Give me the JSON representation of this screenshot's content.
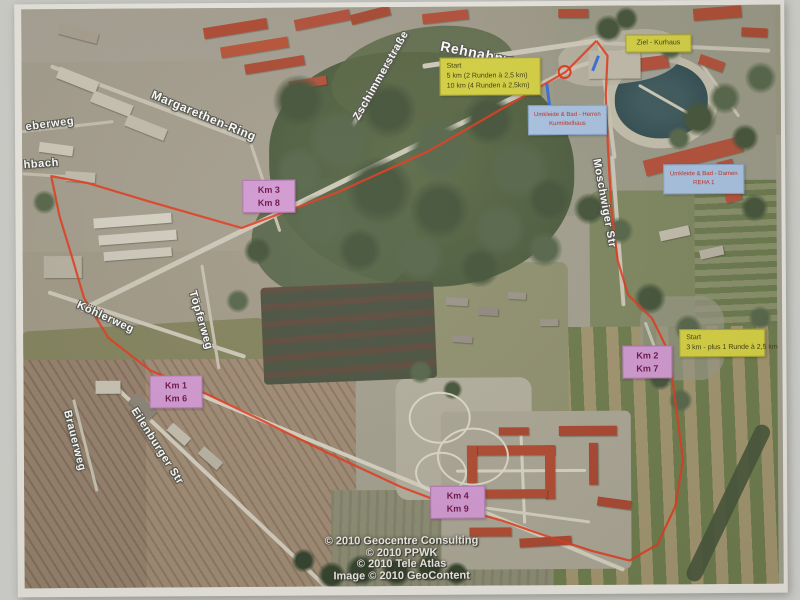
{
  "street_labels": [
    {
      "id": "rehnahnweg",
      "text": "Rehnahnweg",
      "x": 444,
      "y": 38,
      "rot": 12,
      "size": 14
    },
    {
      "id": "zschimmerstrasse",
      "text": "Zschimmerstraße",
      "x": 352,
      "y": 116,
      "rot": -60,
      "size": 11
    },
    {
      "id": "margarethen-ring",
      "text": "Margarethen-Ring",
      "x": 156,
      "y": 86,
      "rot": 23,
      "size": 12
    },
    {
      "id": "eberweg",
      "text": "eberweg",
      "x": 26,
      "y": 119,
      "rot": -7,
      "size": 11
    },
    {
      "id": "hbach",
      "text": "hbach",
      "x": 24,
      "y": 157,
      "rot": -4,
      "size": 11
    },
    {
      "id": "koehlerweg",
      "text": "Köhlerweg",
      "x": 80,
      "y": 297,
      "rot": 25,
      "size": 11
    },
    {
      "id": "toepferweg",
      "text": "Töpferweg",
      "x": 198,
      "y": 288,
      "rot": 74,
      "size": 11
    },
    {
      "id": "brauerweg",
      "text": "Brauerweg",
      "x": 72,
      "y": 407,
      "rot": 76,
      "size": 11
    },
    {
      "id": "eilenburger-str",
      "text": "Eilenburger Str",
      "x": 138,
      "y": 404,
      "rot": 58,
      "size": 11
    },
    {
      "id": "moschwiger-str",
      "text": "Moschwiger Str",
      "x": 603,
      "y": 159,
      "rot": 80,
      "size": 11
    }
  ],
  "boxes": {
    "start_main": {
      "x": 441,
      "y": 58,
      "w": 101,
      "h": 38,
      "lines": [
        "Start",
        "5 km (2 Runden à 2,5 km)",
        "10 km (4 Runden à 2,5km)"
      ]
    },
    "ziel": {
      "x": 627,
      "y": 36,
      "w": 66,
      "h": 18,
      "lines": [
        "Ziel - Kurhaus"
      ]
    },
    "start_3km": {
      "x": 679,
      "y": 331,
      "w": 86,
      "h": 28,
      "lines": [
        "Start",
        "3 km - plus 1 Runde à 2,5 km"
      ]
    },
    "km": [
      {
        "x": 243,
        "y": 179,
        "w": 53,
        "h": 33,
        "lines": [
          "Km 3",
          "Km 8"
        ]
      },
      {
        "x": 149,
        "y": 374,
        "w": 53,
        "h": 33,
        "lines": [
          "Km 1",
          "Km 6"
        ]
      },
      {
        "x": 622,
        "y": 347,
        "w": 50,
        "h": 33,
        "lines": [
          "Km 2",
          "Km 7"
        ]
      },
      {
        "x": 429,
        "y": 486,
        "w": 55,
        "h": 33,
        "lines": [
          "Km 4",
          "Km 9"
        ]
      }
    ],
    "info": [
      {
        "x": 529,
        "y": 106,
        "w": 79,
        "h": 30,
        "lines": [
          "Umkleide & Bad - Herren",
          "Kurmittelhaus"
        ]
      },
      {
        "x": 664,
        "y": 166,
        "w": 81,
        "h": 30,
        "lines": [
          "Umkleide & Bad - Damen",
          "REHA 1"
        ]
      }
    ]
  },
  "attribution": [
    "© 2010 Geocentre Consulting",
    "© 2010 PPWK",
    "© 2010 Tele Atlas",
    "Image © 2010 GeoContent"
  ],
  "route": {
    "color": "#e5391c",
    "points": [
      [
        598,
        42
      ],
      [
        567,
        73
      ],
      [
        430,
        151
      ],
      [
        338,
        192
      ],
      [
        242,
        227
      ],
      [
        150,
        200
      ],
      [
        88,
        181
      ],
      [
        52,
        174
      ],
      [
        60,
        214
      ],
      [
        72,
        254
      ],
      [
        84,
        296
      ],
      [
        108,
        336
      ],
      [
        150,
        369
      ],
      [
        196,
        388
      ],
      [
        258,
        418
      ],
      [
        330,
        454
      ],
      [
        400,
        487
      ],
      [
        452,
        507
      ],
      [
        500,
        521
      ],
      [
        545,
        537
      ],
      [
        590,
        552
      ],
      [
        628,
        562
      ],
      [
        656,
        546
      ],
      [
        674,
        508
      ],
      [
        682,
        462
      ],
      [
        677,
        422
      ],
      [
        673,
        390
      ],
      [
        668,
        353
      ],
      [
        652,
        320
      ],
      [
        628,
        296
      ],
      [
        618,
        262
      ],
      [
        612,
        212
      ],
      [
        609,
        152
      ],
      [
        607,
        96
      ],
      [
        609,
        57
      ],
      [
        598,
        42
      ]
    ],
    "start_circle": {
      "cx": 566,
      "cy": 73,
      "r": 6
    },
    "aux_marks_color": "#3a6fd8",
    "aux_marks": [
      [
        548,
        84,
        551,
        108
      ],
      [
        600,
        57,
        594,
        72
      ]
    ]
  },
  "colors": {
    "marker_yellow": "#d7d243",
    "marker_pink": "#d29ad2",
    "marker_blue": "#a9c3e2",
    "route_red": "#e5391c"
  }
}
